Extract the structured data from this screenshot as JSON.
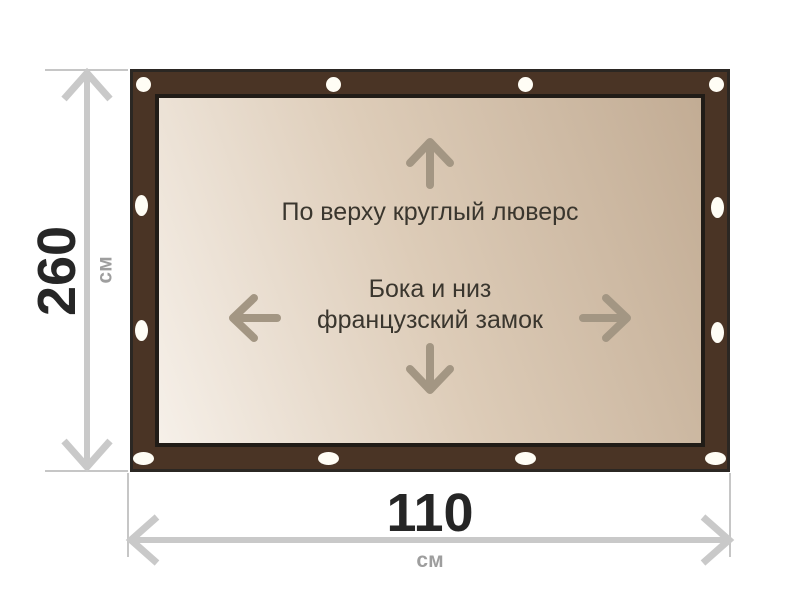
{
  "diagram": {
    "annotations": {
      "top": "По верху круглый люверс",
      "middle_line1": "Бока и низ",
      "middle_line2": "французский замок"
    },
    "height_dimension": {
      "value": "260",
      "unit": "см"
    },
    "width_dimension": {
      "value": "110",
      "unit": "см"
    },
    "colors": {
      "tarp_band": "#4a3425",
      "tarp_outline": "#2b2723",
      "canvas_light": "#f6f0e9",
      "canvas_dark": "#c2ac94",
      "grommet": "#fffdf5",
      "inner_arrow": "#a39683",
      "dimension_line": "#c9c9c9",
      "annotation_text": "#3a362e",
      "dimension_value": "#262626",
      "dimension_unit": "#9e9e9e"
    }
  }
}
